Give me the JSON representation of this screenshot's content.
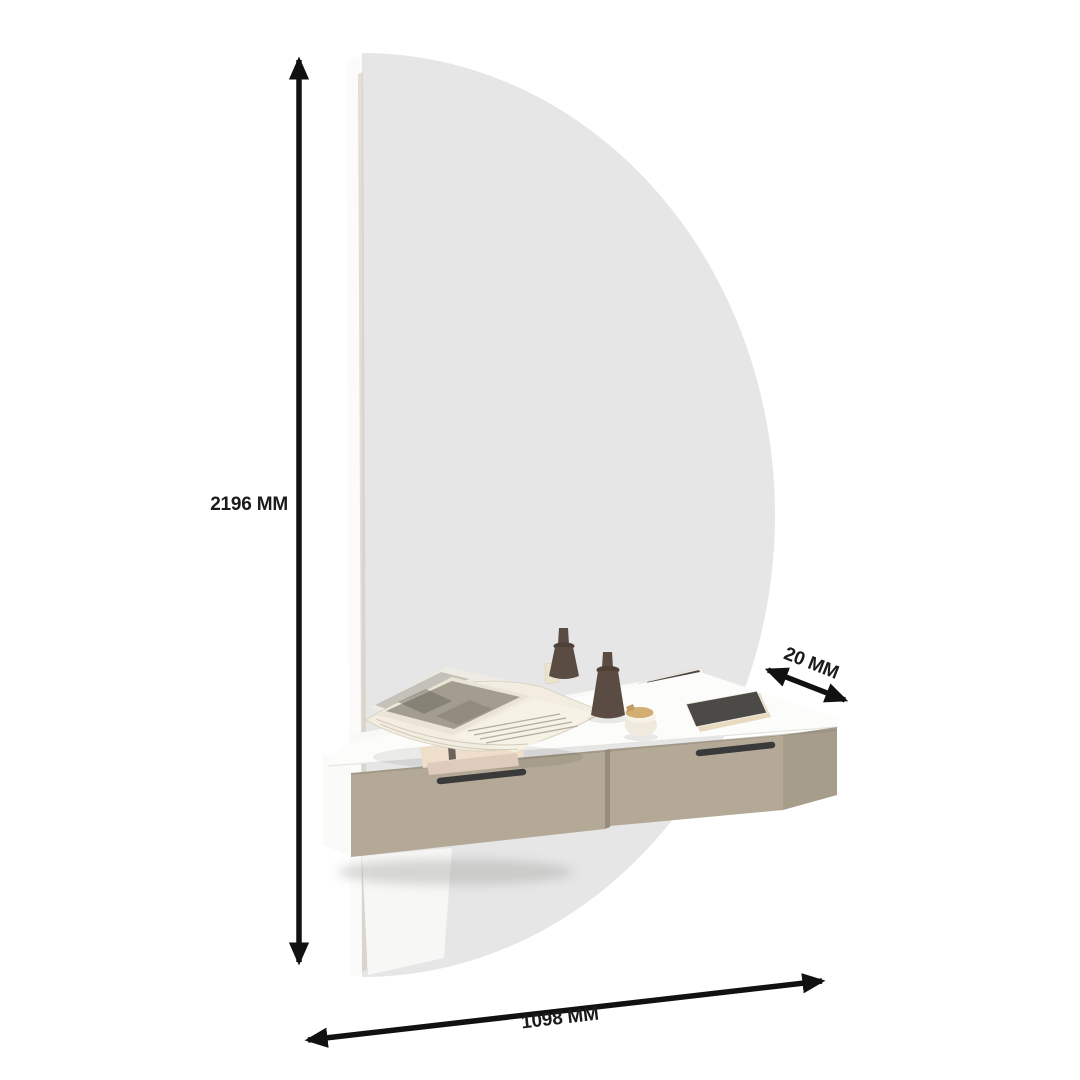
{
  "diagram": {
    "kind": "furniture-dimension-diagram",
    "product": "wall-mounted dressing table with semicircular mirror and two drawers"
  },
  "dimension_labels": {
    "height": "2196 MM",
    "width": "1098 MM",
    "depth": "20 MM"
  },
  "colors": {
    "background": "#ffffff",
    "arrow": "#111111",
    "label_text": "#1b1b1b",
    "mirror_glass": "#e6e6e7",
    "panel_white": "#fbfbfa",
    "panel_edge": "#cdc6b6",
    "cabinet_top": "#fcfcfb",
    "cabinet_side": "#fafaf9",
    "drawer_front": "#b3a996",
    "drawer_side": "#a79d8b",
    "drawer_gap": "#968c7c",
    "handle": "#3a3a3a",
    "candle": "#5a4c43",
    "candle_flange": "#4e4138",
    "book_cover": "#efdecb",
    "gold_lid": "#d2ae70",
    "screen_dark": "#4c4a47",
    "page_cream": "#f2ede0",
    "photo_gray": "#a29d8f"
  }
}
